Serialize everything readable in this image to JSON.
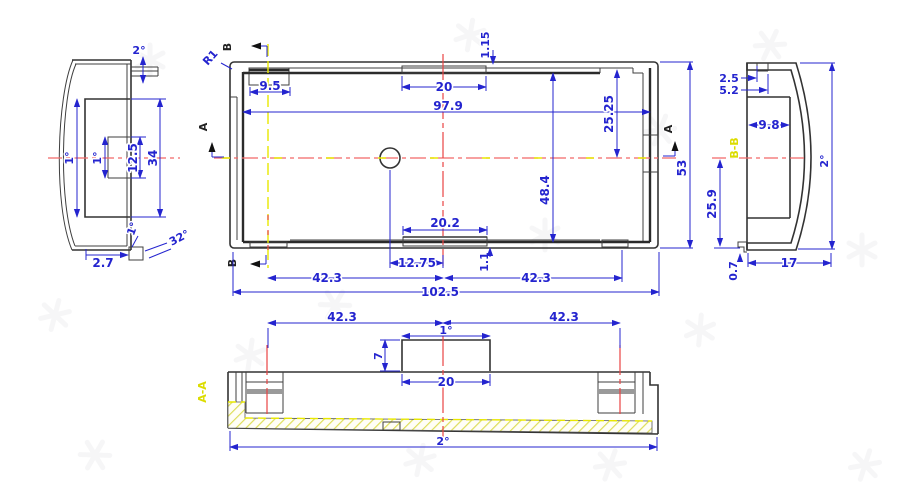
{
  "drawing": {
    "type": "cad-three-view-enclosure-drawing",
    "colors": {
      "dimension_blue": "#2424cf",
      "geometry_dark": "#3a3a3a",
      "centerline_red": "#f26868",
      "section_line_yellow": "#e8e800",
      "hatch_yellow": "#dede5a",
      "boss_gray": "#9a9a9a"
    },
    "views": {
      "left": {
        "labels": {
          "top_angle": "2°",
          "outer_draft": "1°",
          "inner_draft": "1°",
          "pocket_height": "12.5",
          "opening_height": "34",
          "bottom_draft": "1°",
          "bottom_angle": "32°",
          "tab_width": "2.7"
        }
      },
      "main": {
        "labels": {
          "section_b_top": "B",
          "section_b_bottom": "B",
          "section_a_left": "A",
          "section_a_right": "A",
          "corner_radius": "R1",
          "notch_width": "9.5",
          "ledge_thickness": "1.15",
          "top_slot_width": "20",
          "inner_width": "97.9",
          "half_height": "25.25",
          "inner_height": "48.4",
          "overall_height": "53",
          "bottom_slot_width": "20.2",
          "hole_offset": "12.75",
          "tab_offset": "1.1",
          "boss_left_offset": "42.3",
          "boss_right_offset": "42.3",
          "overall_width": "102.5"
        }
      },
      "right": {
        "labels": {
          "notch_width": "2.5",
          "notch_offset": "5.2",
          "pocket_depth": "9.8",
          "section_name": "B-B",
          "lower_height": "25.9",
          "wall_draft": "2°",
          "base_width": "17",
          "lip_thickness": "0.7"
        }
      },
      "section": {
        "labels": {
          "section_name": "A-A",
          "boss_left_offset": "42.3",
          "boss_right_offset": "42.3",
          "block_draft": "1°",
          "block_height": "7",
          "block_width": "20",
          "base_draft": "2°"
        }
      }
    }
  }
}
